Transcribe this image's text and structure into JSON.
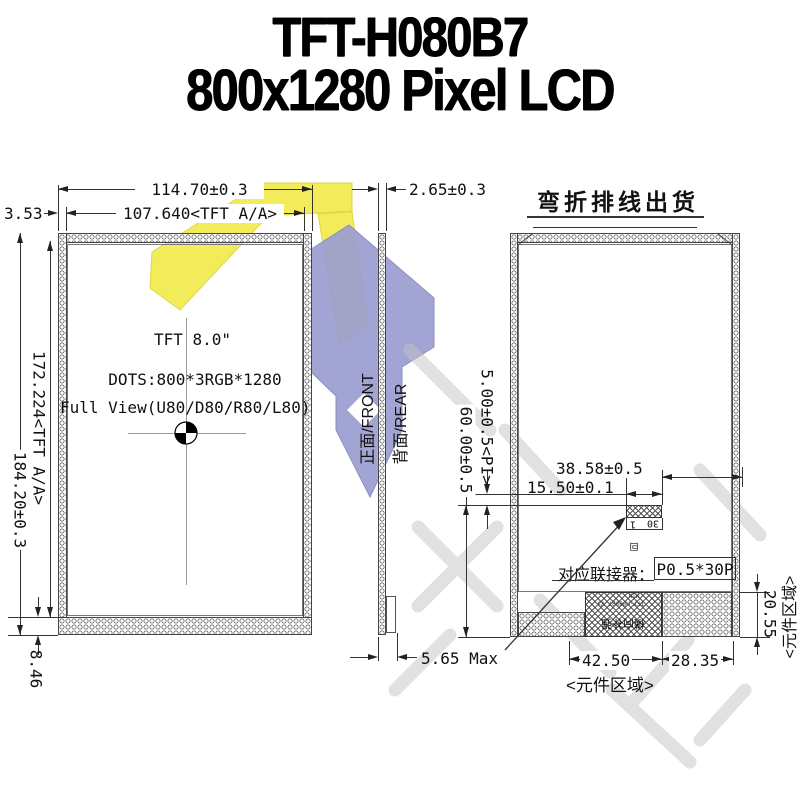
{
  "title": {
    "line1": "TFT-H080B7",
    "line2": "800x1280 Pixel LCD"
  },
  "front_view": {
    "dim_width_outer": "114.70±0.3",
    "dim_width_aa": "107.640<TFT A/A>",
    "dim_offset_left": "3.53",
    "dim_height_outer": "184.20±0.3",
    "dim_height_aa": "172.224<TFT A/A>",
    "dim_offset_bottom": "8.46",
    "label_size": "TFT 8.0\"",
    "label_dots": "DOTS:800*3RGB*1280",
    "label_view": "Full View(U80/D80/R80/L80)"
  },
  "side_view": {
    "dim_thickness": "2.65±0.3",
    "label_front": "正面/FRONT",
    "label_rear": "背面/REAR",
    "dim_max": "5.65 Max"
  },
  "rear_view": {
    "title": "弯折排线出货",
    "dim_pi": "5.00±0.5<PI>",
    "dim_total": "60.00±0.5",
    "dim_3858": "38.58±0.5",
    "dim_1550": "15.50±0.1",
    "connector_label": "对应联接器：",
    "connector_value": "P0.5*30P",
    "pin_left": "1",
    "pin_right": "30",
    "mark_small": "囙",
    "tiny_min": "MIN",
    "tiny_model": "TFT-H080B7 V3",
    "stiffener": "横向补强",
    "dim_2055": "20.55",
    "dim_4250": "42.50",
    "dim_2835": "28.35",
    "area_label_bottom": "<元件区域>",
    "area_label_right": "<元件区域>"
  },
  "watermark": {
    "yellow": "#f3ec52",
    "purple": "#9b9ed0",
    "gray": "#c4c4c4"
  }
}
